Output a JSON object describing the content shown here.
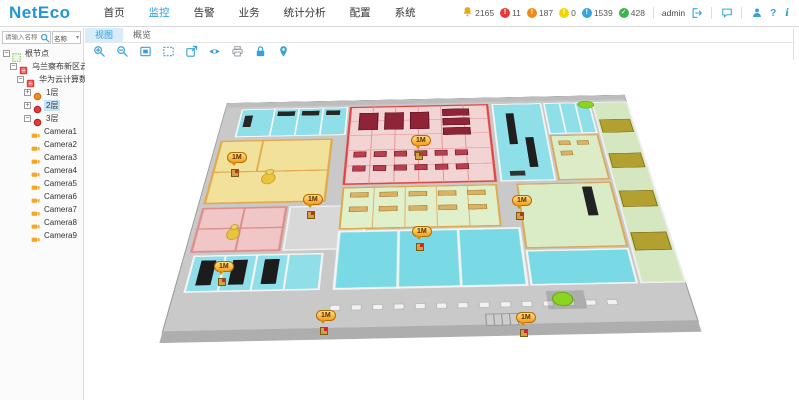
{
  "header": {
    "logo": "NetEco",
    "menu": [
      {
        "id": "home",
        "label": "首页",
        "active": false
      },
      {
        "id": "monitor",
        "label": "监控",
        "active": true
      },
      {
        "id": "alarm",
        "label": "告警",
        "active": false
      },
      {
        "id": "service",
        "label": "业务",
        "active": false
      },
      {
        "id": "statistics",
        "label": "统计分析",
        "active": false
      },
      {
        "id": "config",
        "label": "配置",
        "active": false
      },
      {
        "id": "system",
        "label": "系统",
        "active": false
      }
    ],
    "alarm_badges": [
      {
        "id": "total",
        "icon": "bell",
        "color": "#e6a817",
        "count": "2165"
      },
      {
        "id": "critical",
        "icon": "exclaim",
        "color": "#e23b3b",
        "count": "11"
      },
      {
        "id": "major",
        "icon": "exclaim",
        "color": "#f08a1d",
        "count": "187"
      },
      {
        "id": "minor",
        "icon": "exclaim",
        "color": "#f0d500",
        "count": "0"
      },
      {
        "id": "warning",
        "icon": "exclaim",
        "color": "#39a3dc",
        "count": "1539"
      },
      {
        "id": "cleared",
        "icon": "check",
        "color": "#3cb54a",
        "count": "428"
      }
    ],
    "user": "admin",
    "help_glyph": "?",
    "info_glyph": "i"
  },
  "sidebar": {
    "search_placeholder": "请输入名称",
    "filter_label": "名称",
    "tree": [
      {
        "id": "root",
        "label": "根节点",
        "level": 0,
        "icon": "root",
        "toggle": "minus"
      },
      {
        "id": "site-ulanqab",
        "label": "乌兰察布新区云计算",
        "level": 1,
        "icon": "site",
        "toggle": "minus"
      },
      {
        "id": "dc-huawei",
        "label": "华为云计算数据中心",
        "level": 2,
        "icon": "site",
        "toggle": "minus"
      },
      {
        "id": "floor-1",
        "label": "1层",
        "level": 3,
        "icon": "floor-orange",
        "toggle": "plus"
      },
      {
        "id": "floor-2",
        "label": "2层",
        "level": 3,
        "icon": "floor-red",
        "toggle": "plus",
        "selected": true
      },
      {
        "id": "floor-3",
        "label": "3层",
        "level": 3,
        "icon": "floor-red",
        "toggle": "minus"
      },
      {
        "id": "camera-1",
        "label": "Camera1",
        "level": 4,
        "icon": "camera"
      },
      {
        "id": "camera-2",
        "label": "Camera2",
        "level": 4,
        "icon": "camera"
      },
      {
        "id": "camera-3",
        "label": "Camera3",
        "level": 4,
        "icon": "camera"
      },
      {
        "id": "camera-4",
        "label": "Camera4",
        "level": 4,
        "icon": "camera"
      },
      {
        "id": "camera-5",
        "label": "Camera5",
        "level": 4,
        "icon": "camera"
      },
      {
        "id": "camera-6",
        "label": "Camera6",
        "level": 4,
        "icon": "camera"
      },
      {
        "id": "camera-7",
        "label": "Camera7",
        "level": 4,
        "icon": "camera"
      },
      {
        "id": "camera-8",
        "label": "Camera8",
        "level": 4,
        "icon": "camera"
      },
      {
        "id": "camera-9",
        "label": "Camera9",
        "level": 4,
        "icon": "camera"
      }
    ]
  },
  "main": {
    "tabs": [
      {
        "id": "view",
        "label": "视图",
        "active": true
      },
      {
        "id": "overview",
        "label": "概览",
        "active": false
      }
    ],
    "toolbar": [
      "zoom-in",
      "zoom-out",
      "fit-view",
      "region-select",
      "fullscreen",
      "view-eye",
      "print",
      "lock",
      "location"
    ],
    "plan_markers": [
      {
        "x": 142,
        "y": 86,
        "label": "1M"
      },
      {
        "x": 326,
        "y": 69,
        "label": "1M"
      },
      {
        "x": 427,
        "y": 129,
        "label": "1M"
      },
      {
        "x": 218,
        "y": 128,
        "label": "1M"
      },
      {
        "x": 327,
        "y": 160,
        "label": "1M"
      },
      {
        "x": 129,
        "y": 195,
        "label": "1M"
      },
      {
        "x": 231,
        "y": 244,
        "label": "1M"
      },
      {
        "x": 431,
        "y": 246,
        "label": "1M"
      }
    ]
  },
  "colors": {
    "accent": "#2b9fd9",
    "selected_zone": "#e04545",
    "marker": "#f6a01c"
  }
}
